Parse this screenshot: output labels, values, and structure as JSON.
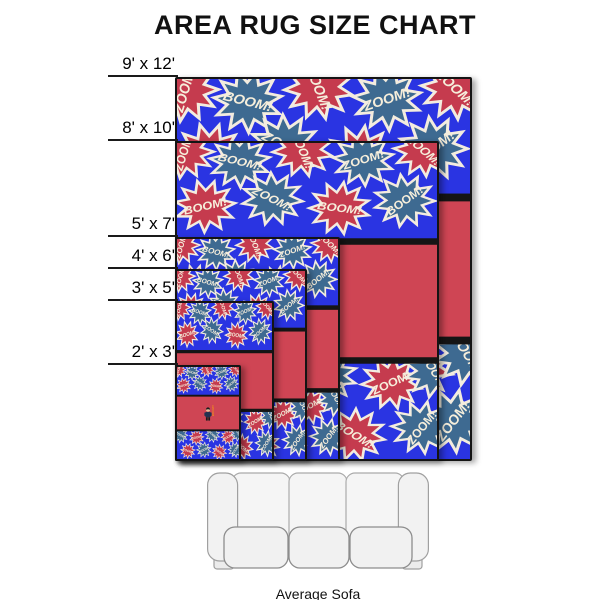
{
  "title": "AREA RUG SIZE CHART",
  "sofa": {
    "label": "Average Sofa"
  },
  "rugs": [
    {
      "label": "9' x 12'",
      "width_ft": 9,
      "height_ft": 12
    },
    {
      "label": "8' x 10'",
      "width_ft": 8,
      "height_ft": 10
    },
    {
      "label": "5' x 7'",
      "width_ft": 5,
      "height_ft": 7
    },
    {
      "label": "4' x 6'",
      "width_ft": 4,
      "height_ft": 6
    },
    {
      "label": "3' x 5'",
      "width_ft": 3,
      "height_ft": 5
    },
    {
      "label": "2' x 3'",
      "width_ft": 2,
      "height_ft": 3
    }
  ],
  "rug_design": {
    "background_color": "#2a34e2",
    "panel_color": "#cf4554",
    "burst_red": "#c53b4e",
    "burst_slate": "#3e6a91",
    "outline_color": "#f3ecdf",
    "text_color": "#f6eedb",
    "border_color": "#151515",
    "boom_text": "BOOM!",
    "zoom_text": "ZOOM!",
    "panel_word": "BOOM!!",
    "panel_word_color": "#f08c1e",
    "bursts": [
      {
        "x": 6,
        "y": 10,
        "c": "red",
        "t": "ZOOM!",
        "r": -75
      },
      {
        "x": 58,
        "y": 20,
        "c": "slate",
        "t": "BOOM!",
        "r": 15
      },
      {
        "x": 116,
        "y": 8,
        "c": "red",
        "t": "BOOM!",
        "r": 70
      },
      {
        "x": 172,
        "y": 18,
        "c": "slate",
        "t": "ZOOM!",
        "r": -20
      },
      {
        "x": 228,
        "y": 8,
        "c": "red",
        "t": "ZOOM!",
        "r": 45
      },
      {
        "x": 26,
        "y": 68,
        "c": "red",
        "t": "BOOM!",
        "r": -15
      },
      {
        "x": 88,
        "y": 60,
        "c": "slate",
        "t": "ZOOM!",
        "r": 30
      },
      {
        "x": 150,
        "y": 70,
        "c": "red",
        "t": "BOOM!",
        "r": 8
      },
      {
        "x": 210,
        "y": 62,
        "c": "slate",
        "t": "BOOM!",
        "r": -40
      },
      {
        "x": 14,
        "y": 252,
        "c": "slate",
        "t": "ZOOM!",
        "r": 25
      },
      {
        "x": 76,
        "y": 260,
        "c": "red",
        "t": "BOOM!",
        "r": -12
      },
      {
        "x": 138,
        "y": 250,
        "c": "slate",
        "t": "BOOM!",
        "r": 42
      },
      {
        "x": 198,
        "y": 258,
        "c": "red",
        "t": "ZOOM!",
        "r": -28
      },
      {
        "x": 238,
        "y": 246,
        "c": "slate",
        "t": "BOOM!",
        "r": 60
      },
      {
        "x": 42,
        "y": 310,
        "c": "red",
        "t": "ZOOM!",
        "r": 18
      },
      {
        "x": 104,
        "y": 306,
        "c": "slate",
        "t": "BOOM!",
        "r": -25
      },
      {
        "x": 164,
        "y": 314,
        "c": "red",
        "t": "BOOM!",
        "r": 35
      },
      {
        "x": 226,
        "y": 306,
        "c": "slate",
        "t": "ZOOM!",
        "r": -55
      }
    ]
  }
}
